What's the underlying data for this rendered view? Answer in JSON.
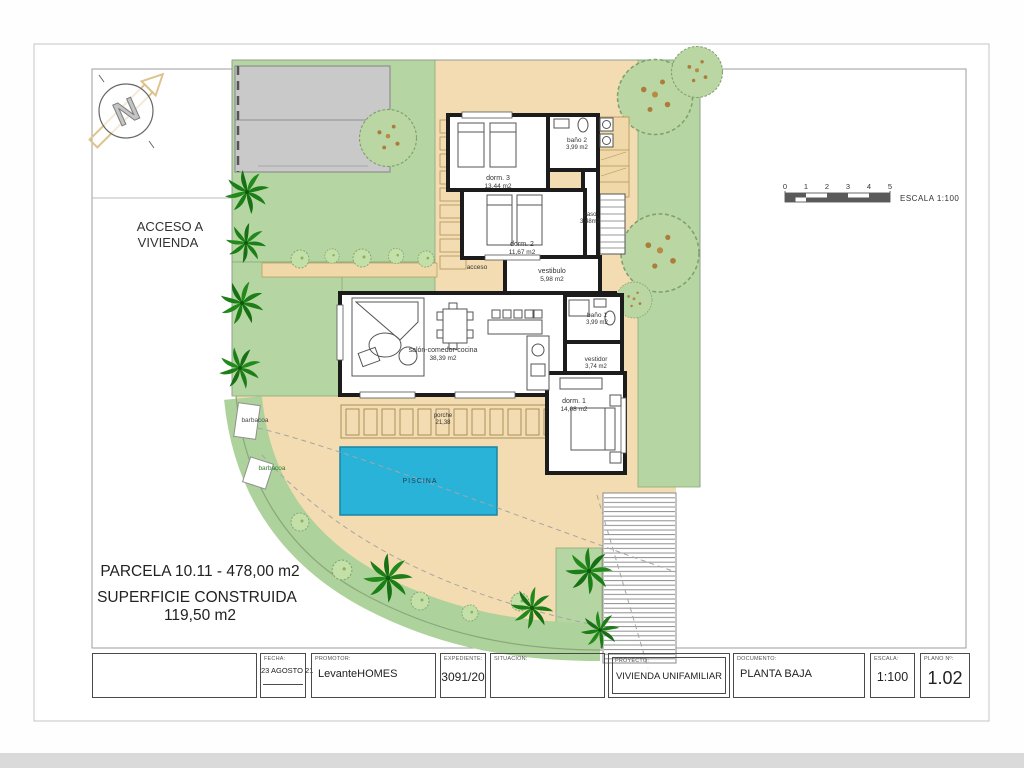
{
  "drawing": {
    "access_label_line1": "ACCESO A",
    "access_label_line2": "VIVIENDA",
    "rooms": {
      "dorm3": {
        "name": "dorm. 3",
        "area": "13,44 m2"
      },
      "bano2": {
        "name": "baño 2",
        "area": "3,99 m2"
      },
      "dorm2": {
        "name": "dorm. 2",
        "area": "11,67 m2"
      },
      "paso": {
        "name": "paso",
        "area": "3,48m2"
      },
      "vestibulo": {
        "name": "vestibulo",
        "area": "5,98 m2"
      },
      "acceso": {
        "name": "acceso"
      },
      "salon": {
        "name": "salón-comedor-cocina",
        "area": "38,39 m2"
      },
      "bano1": {
        "name": "baño 1",
        "area": "3,99 m2"
      },
      "vestidor": {
        "name": "vestidor",
        "area": "3,74 m2"
      },
      "dorm1": {
        "name": "dorm. 1",
        "area": "14,08 m2"
      }
    },
    "outdoor": {
      "porche_name": "porche",
      "porche_area": "21,38",
      "piscina": "PISCINA",
      "barbacoa_upper": "barbacoa",
      "barbacoa_lower": "barbacoa"
    },
    "summary": {
      "parcela": "PARCELA 10.11 - 478,00 m2",
      "superficie_line1": "SUPERFICIE CONSTRUIDA",
      "superficie_line2": "119,50 m2"
    },
    "scalebar": {
      "ticks": [
        "0",
        "1",
        "2",
        "3",
        "4",
        "5"
      ],
      "label": "ESCALA  1:100"
    }
  },
  "titleblock": {
    "fields": [
      {
        "label": "",
        "value": ""
      },
      {
        "label": "FECHA:",
        "value": "23 AGOSTO 21"
      },
      {
        "label": "PROMOTOR:",
        "value": "LevanteHOMES"
      },
      {
        "label": "EXPEDIENTE:",
        "value": "3091/20"
      },
      {
        "label": "SITUACION:",
        "value": ""
      },
      {
        "label": "PROYECTO:",
        "value": "VIVIENDA UNIFAMILIAR"
      },
      {
        "label": "DOCUMENTO:",
        "value": "PLANTA BAJA"
      },
      {
        "label": "ESCALA:",
        "value": "1:100"
      },
      {
        "label": "PLANO Nº:",
        "value": "1.02"
      }
    ]
  },
  "colors": {
    "lawn": "#b5d6a2",
    "sand": "#f3dcb2",
    "pool": "#29b3d8",
    "palm": "#1b7e16",
    "garage": "#c9c9c9"
  }
}
